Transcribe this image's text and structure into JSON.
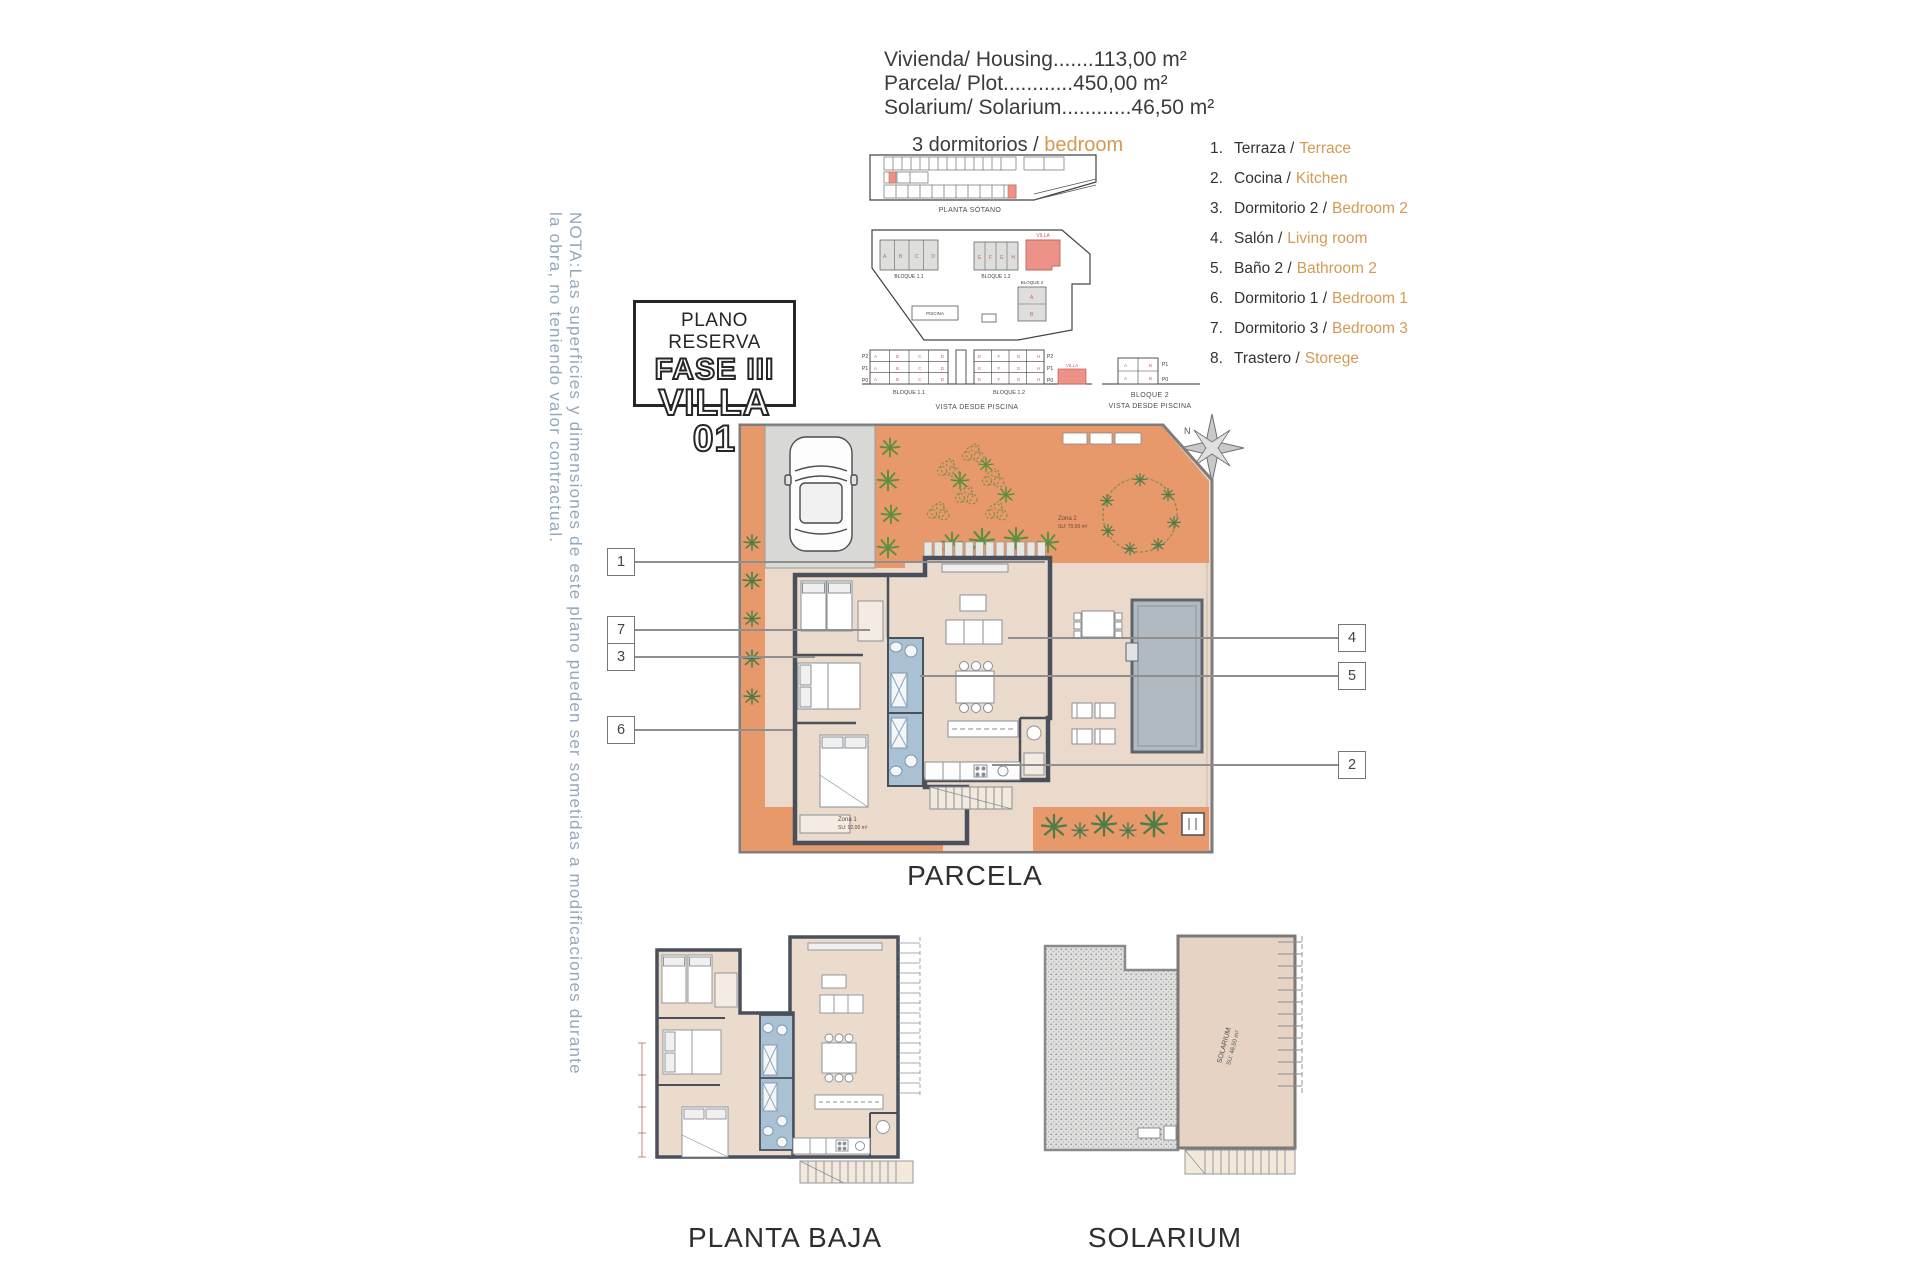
{
  "specs": {
    "line1": "Vivienda/ Housing.......113,00 m²",
    "line2": "Parcela/ Plot............450,00 m²",
    "line3": "Solarium/ Solarium............46,50 m²"
  },
  "subtitle": {
    "es": "3 dormitorios /",
    "en": "bedroom"
  },
  "title_box": {
    "line1": "PLANO RESERVA",
    "line2": "FASE III",
    "line3": "VILLA 01"
  },
  "legend": {
    "items": [
      {
        "num": "1.",
        "es": "Terraza /",
        "en": "Terrace"
      },
      {
        "num": "2.",
        "es": "Cocina /",
        "en": "Kitchen"
      },
      {
        "num": "3.",
        "es": "Dormitorio 2 /",
        "en": "Bedroom 2"
      },
      {
        "num": "4.",
        "es": "Salón /",
        "en": "Living room"
      },
      {
        "num": "5.",
        "es": "Baño 2 /",
        "en": "Bathroom 2"
      },
      {
        "num": "6.",
        "es": "Dormitorio 1 /",
        "en": "Bedroom 1"
      },
      {
        "num": "7.",
        "es": "Dormitorio 3 /",
        "en": "Bedroom 3"
      },
      {
        "num": "8.",
        "es": "Trastero /",
        "en": "Storege"
      }
    ]
  },
  "note": "NOTA:Las superficies y dimensiones de este plano pueden ser sometidas a modificaciones durante la obra, no teniendo valor contractual.",
  "site": {
    "sotano_caption": "PLANTA SÓTANO",
    "bloque11": "BLOQUE 1.1",
    "bloque12": "BLOQUE 1.2",
    "bloque2": "BLOQUE 2",
    "villa": "VILLA",
    "piscina": "PISCINA",
    "vista": "VISTA DESDE PISCINA",
    "floor_p2": "P2",
    "floor_p1": "P1",
    "floor_p0": "P0",
    "cells11": "A B C D",
    "cells12": "E F G H",
    "cells2": "A B"
  },
  "parcela": {
    "label": "PARCELA",
    "compass": "N",
    "zona1": "Zona 1",
    "zona1_area": "SU: 92,00 m²",
    "zona2": "Zona 2",
    "zona2_area": "SU: 79,00 m²",
    "callouts": [
      "1",
      "7",
      "3",
      "6",
      "4",
      "5",
      "2"
    ]
  },
  "planta_baja": {
    "label": "PLANTA BAJA"
  },
  "solarium": {
    "label": "SOLARIUM",
    "inner": "SOLARIUM",
    "inner_area": "SU: 46,50 m²"
  },
  "colors": {
    "accent_orange": "#D49A54",
    "terrace_orange": "#E7996C",
    "pavement_beige": "#EBDACB",
    "wall_dark": "#4A505B",
    "bath_blue": "#A9C1D3",
    "pool_gray": "#B2BAC1",
    "highlight_red": "#EC9289",
    "palm_green": "#5E8F3E",
    "note_blue": "#94A8BC"
  }
}
